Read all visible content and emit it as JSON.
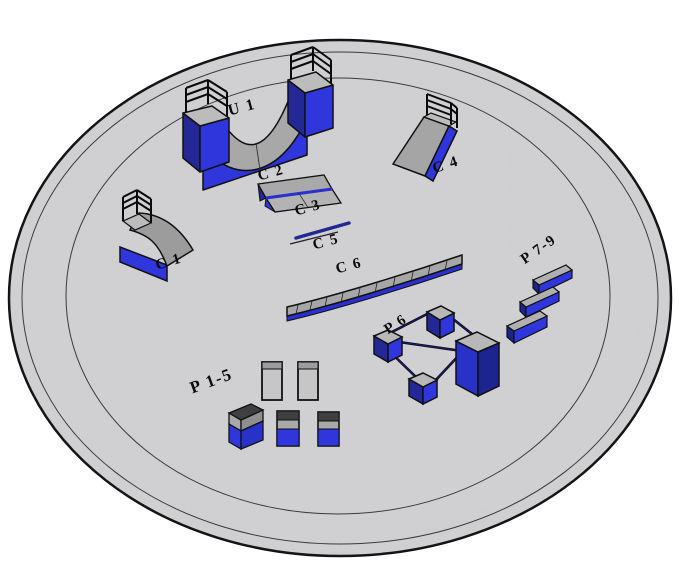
{
  "scene": {
    "description": "3D skatepark layout on an elliptical pad",
    "labels": {
      "u1": "U 1",
      "c1": "C 1",
      "c2": "C 2",
      "c3": "C 3",
      "c4": "C 4",
      "c5": "C 5",
      "c6": "C 6",
      "p1_5": "P 1-5",
      "p6": "P 6",
      "p7_9": "P 7-9"
    },
    "items": [
      {
        "id": "U 1",
        "type": "halfpipe"
      },
      {
        "id": "C 1",
        "type": "quarterpipe-with-railing"
      },
      {
        "id": "C 2",
        "type": "bank-ramp"
      },
      {
        "id": "C 3",
        "type": "bank-ramp"
      },
      {
        "id": "C 4",
        "type": "bank-ramp-with-railing"
      },
      {
        "id": "C 5",
        "type": "flat-rail"
      },
      {
        "id": "C 6",
        "type": "segmented-ledge"
      },
      {
        "id": "P 1-5",
        "type": "boxes-and-pads"
      },
      {
        "id": "P 6",
        "type": "rail-square-with-boxes"
      },
      {
        "id": "P 7-9",
        "type": "three-ledges"
      }
    ],
    "colors": {
      "background": "#ffffff",
      "ground": "#d5d5d7",
      "outline": "#111111",
      "blue_front": "#2f36dc",
      "blue_side": "#232896",
      "rail_blue": "#1b1b6e",
      "gray_surface": "#a8a8a8",
      "gray_top": "#bcbcbc",
      "dark_band": "#3f3f3f",
      "railing": "#0a0a0a"
    }
  }
}
